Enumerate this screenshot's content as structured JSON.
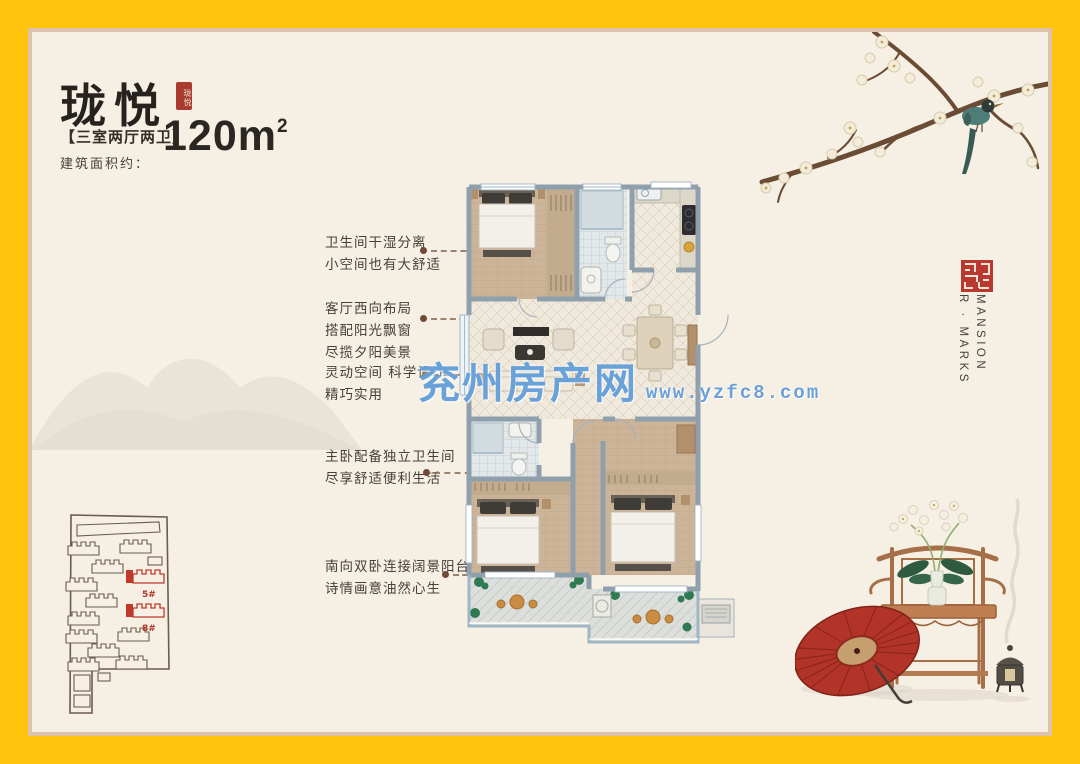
{
  "colors": {
    "frame": "#FFC30D",
    "paper": "#F6EFE4",
    "inner_edge": "#DCC2AA",
    "seal_red": "#A93A2E",
    "site_highlight": "#C0392B",
    "watermark_blue": "#5494D4",
    "wall": "#8FA0AC"
  },
  "header": {
    "title": "珑悦",
    "title_seal": "珑悦",
    "spec": "【三室两厅两卫】",
    "area_label": "建筑面积约：",
    "area_value": "120m",
    "area_sup": "2"
  },
  "annotations": [
    {
      "lines": [
        "卫生间干湿分离",
        "小空间也有大舒适"
      ]
    },
    {
      "lines": [
        "客厅西向布局",
        "搭配阳光飘窗",
        "尽揽夕阳美景"
      ]
    },
    {
      "lines": [
        "灵动空间 科学设计",
        "精巧实用"
      ]
    },
    {
      "lines": [
        "主卧配备独立卫生间",
        "尽享舒适便利生活"
      ]
    },
    {
      "lines": [
        "南向双卧连接阔景阳台",
        "诗情画意油然心生"
      ]
    }
  ],
  "watermark": {
    "name": "兖州房产网",
    "url": "www.yzfc8.com"
  },
  "brand": {
    "vertical_right": "MANSION",
    "vertical_left": "R · MARKS"
  },
  "site_plan": {
    "labels": [
      "5#",
      "8#"
    ]
  }
}
